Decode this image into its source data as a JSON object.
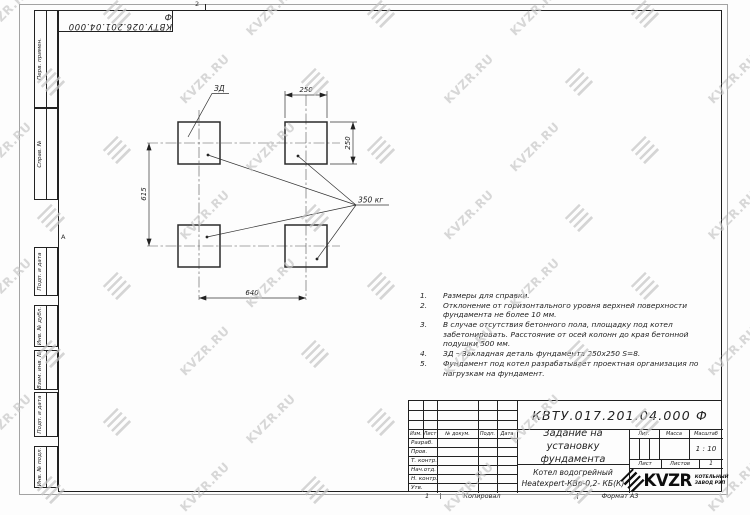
{
  "sheet": {
    "corner_stamp": "КВТУ.026.201.04.000 Ф",
    "zone_top": "2",
    "zone_left": "А",
    "zone_bottom": "1",
    "footer_copied": "Копировал",
    "footer_format": "Формат А3"
  },
  "side_stamps": {
    "perv_primen": "Перв. примен.",
    "sprav_no": "Справ. №",
    "podp_data_1": "Подп. и дата",
    "inv_dubl": "Инв. № дубл.",
    "vzam_inv": "Взам. инв. №",
    "podp_data_2": "Подп. и дата",
    "inv_podl": "Инв. № подл."
  },
  "drawing": {
    "detail_label": "ЗД",
    "dim_pad_width": "250",
    "dim_pad_height": "250",
    "dim_row_spacing": "615",
    "dim_col_spacing": "640",
    "load_label": "350 кг"
  },
  "notes": [
    {
      "num": "1.",
      "text": "Размеры для справки."
    },
    {
      "num": "2.",
      "text": "Отклонение от горизонтального уровня верхней поверхности фундамента не более 10 мм."
    },
    {
      "num": "3.",
      "text": "В случае отсутствия бетонного пола, площадку под котел забетонировать. Расстояние от осей колонн до края бетонной подушки 500 мм."
    },
    {
      "num": "4.",
      "text": "ЗД – Закладная деталь фундамента 250х250 S=8."
    },
    {
      "num": "5.",
      "text": "Фундамент под котел разрабатывает проектная организация по нагрузкам на фундамент."
    }
  ],
  "title_block": {
    "doc_number": "КВТУ.017.201.04.000 Ф",
    "title": "Задание на установку фундамента",
    "product_line1": "Котел водогрейный",
    "product_line2": "Heatexpert-КВр-0,2- КБ(К)",
    "scale_value": "1 : 10",
    "sheets_total": "1",
    "labels": {
      "izm": "Изм.",
      "list": "Лист",
      "n_dokum": "№ докум.",
      "podp": "Подп.",
      "data": "Дата",
      "razrab": "Разраб.",
      "prov": "Пров.",
      "t_kontr": "Т. контр.",
      "nach_otd": "Нач.отд.",
      "n_kontr": "Н. контр.",
      "utv": "Утв.",
      "lit": "Лит.",
      "massa": "Масса",
      "masshtab": "Масштаб",
      "list2": "Лист",
      "listov": "Листов"
    },
    "logo_text": "KVZR",
    "logo_tagline1": "КОТЕЛЬНЫЙ",
    "logo_tagline2": "ЗАВОД РЭП"
  },
  "watermark": {
    "text": "KVZR.RU"
  }
}
